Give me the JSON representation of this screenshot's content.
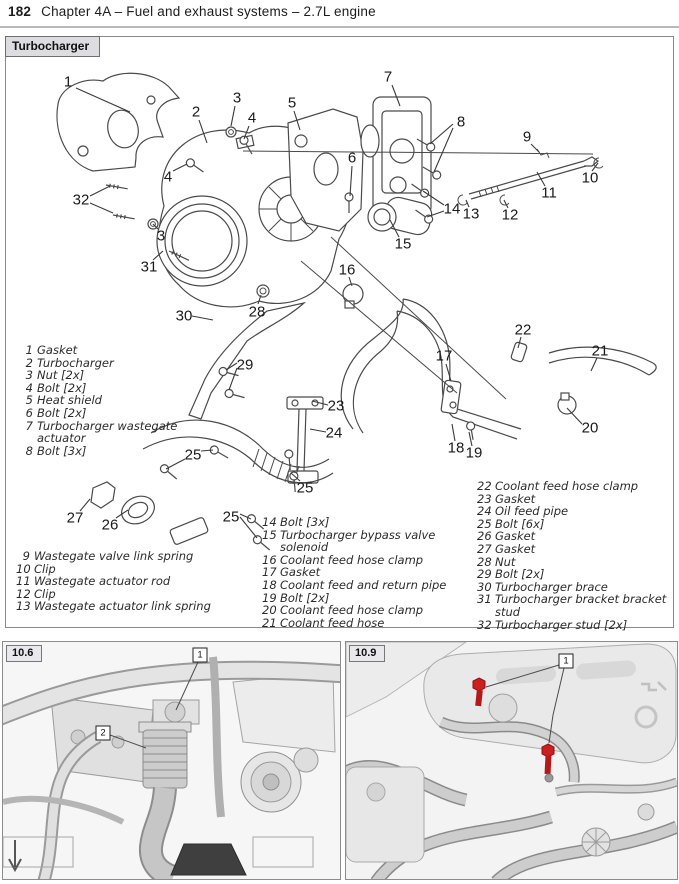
{
  "page": {
    "number": "182",
    "title": "Chapter 4A – Fuel and exhaust systems – 2.7L engine"
  },
  "figure": {
    "tab": "Turbocharger",
    "legend": {
      "columns": [
        {
          "x": 25,
          "y": 344,
          "w": 168,
          "nw": 8,
          "items": [
            {
              "num": "1",
              "text": "Gasket"
            },
            {
              "num": "2",
              "text": "Turbocharger"
            },
            {
              "num": "3",
              "text": "Nut [2x]"
            },
            {
              "num": "4",
              "text": "Bolt [2x]"
            },
            {
              "num": "5",
              "text": "Heat shield"
            },
            {
              "num": "6",
              "text": "Bolt [2x]"
            },
            {
              "num": "7",
              "text": "Turbocharger wastegate actuator"
            },
            {
              "num": "8",
              "text": "Bolt [3x]"
            }
          ]
        },
        {
          "x": 16,
          "y": 550,
          "w": 205,
          "nw": 14,
          "items": [
            {
              "num": "9",
              "text": "Wastegate valve link spring"
            },
            {
              "num": "10",
              "text": "Clip"
            },
            {
              "num": "11",
              "text": "Wastegate actuator rod"
            },
            {
              "num": "12",
              "text": "Clip"
            },
            {
              "num": "13",
              "text": "Wastegate actuator link spring"
            }
          ]
        },
        {
          "x": 262,
          "y": 516,
          "w": 210,
          "nw": 14,
          "items": [
            {
              "num": "14",
              "text": "Bolt [3x]"
            },
            {
              "num": "15",
              "text": "Turbocharger bypass valve solenoid"
            },
            {
              "num": "16",
              "text": "Coolant feed hose clamp"
            },
            {
              "num": "17",
              "text": "Gasket"
            },
            {
              "num": "18",
              "text": "Coolant feed and return pipe"
            },
            {
              "num": "19",
              "text": "Bolt [2x]"
            },
            {
              "num": "20",
              "text": "Coolant feed hose clamp"
            },
            {
              "num": "21",
              "text": "Coolant feed hose"
            }
          ]
        },
        {
          "x": 477,
          "y": 480,
          "w": 200,
          "nw": 14,
          "items": [
            {
              "num": "22",
              "text": "Coolant feed hose clamp"
            },
            {
              "num": "23",
              "text": "Gasket"
            },
            {
              "num": "24",
              "text": "Oil feed pipe"
            },
            {
              "num": "25",
              "text": "Bolt [6x]"
            },
            {
              "num": "26",
              "text": "Gasket"
            },
            {
              "num": "27",
              "text": "Gasket"
            },
            {
              "num": "28",
              "text": "Nut"
            },
            {
              "num": "29",
              "text": "Bolt [2x]"
            },
            {
              "num": "30",
              "text": "Turbocharger brace"
            },
            {
              "num": "31",
              "text": "Turbocharger bracket bracket stud"
            },
            {
              "num": "32",
              "text": "Turbocharger stud [2x]"
            }
          ]
        }
      ]
    },
    "callouts": [
      {
        "n": "1",
        "x": 68,
        "y": 82,
        "leaders": [
          [
            [
              76,
              88
            ],
            [
              130,
              112
            ]
          ]
        ]
      },
      {
        "n": "2",
        "x": 196,
        "y": 112,
        "leaders": [
          [
            [
              199,
              120
            ],
            [
              207,
              143
            ]
          ]
        ]
      },
      {
        "n": "3",
        "x": 237,
        "y": 98,
        "leaders": [
          [
            [
              235,
              106
            ],
            [
              231,
              126
            ]
          ]
        ]
      },
      {
        "n": "4",
        "x": 252,
        "y": 118,
        "leaders": [
          [
            [
              249,
              126
            ],
            [
              244,
              139
            ]
          ]
        ]
      },
      {
        "n": "5",
        "x": 292,
        "y": 103,
        "leaders": [
          [
            [
              294,
              111
            ],
            [
              300,
              130
            ]
          ]
        ]
      },
      {
        "n": "6",
        "x": 352,
        "y": 158,
        "leaders": [
          [
            [
              352,
              166
            ],
            [
              350,
              196
            ]
          ]
        ]
      },
      {
        "n": "7",
        "x": 388,
        "y": 77,
        "leaders": [
          [
            [
              392,
              85
            ],
            [
              400,
              106
            ]
          ]
        ]
      },
      {
        "n": "8",
        "x": 461,
        "y": 122,
        "leaders": [
          [
            [
              453,
              124
            ],
            [
              430,
              144
            ]
          ],
          [
            [
              453,
              128
            ],
            [
              434,
              172
            ]
          ]
        ]
      },
      {
        "n": "9",
        "x": 527,
        "y": 137,
        "leaders": [
          [
            [
              531,
              144
            ],
            [
              539,
              152
            ]
          ]
        ]
      },
      {
        "n": "10",
        "x": 590,
        "y": 178,
        "leaders": [
          [
            [
              592,
              171
            ],
            [
              598,
              163
            ]
          ]
        ]
      },
      {
        "n": "11",
        "x": 549,
        "y": 193,
        "leaders": [
          [
            [
              545,
              186
            ],
            [
              537,
              172
            ]
          ]
        ]
      },
      {
        "n": "12",
        "x": 510,
        "y": 215,
        "leaders": [
          [
            [
              508,
              208
            ],
            [
              504,
              200
            ]
          ]
        ]
      },
      {
        "n": "13",
        "x": 471,
        "y": 214,
        "leaders": [
          [
            [
              469,
              207
            ],
            [
              466,
              200
            ]
          ]
        ]
      },
      {
        "n": "14",
        "x": 452,
        "y": 209,
        "leaders": [
          [
            [
              444,
              205
            ],
            [
              423,
              191
            ]
          ],
          [
            [
              444,
              211
            ],
            [
              427,
              217
            ]
          ]
        ]
      },
      {
        "n": "15",
        "x": 403,
        "y": 244,
        "leaders": [
          [
            [
              399,
              237
            ],
            [
              390,
              220
            ]
          ]
        ]
      },
      {
        "n": "16",
        "x": 347,
        "y": 270,
        "leaders": [
          [
            [
              349,
              277
            ],
            [
              352,
              286
            ]
          ]
        ]
      },
      {
        "n": "17",
        "x": 444,
        "y": 356,
        "leaders": [
          [
            [
              446,
              364
            ],
            [
              451,
              381
            ]
          ]
        ]
      },
      {
        "n": "18",
        "x": 456,
        "y": 448,
        "leaders": [
          [
            [
              455,
              441
            ],
            [
              452,
              424
            ]
          ]
        ]
      },
      {
        "n": "19",
        "x": 474,
        "y": 453,
        "leaders": [
          [
            [
              472,
              446
            ],
            [
              469,
              432
            ]
          ]
        ]
      },
      {
        "n": "20",
        "x": 590,
        "y": 428,
        "leaders": [
          [
            [
              582,
              424
            ],
            [
              567,
              408
            ]
          ]
        ]
      },
      {
        "n": "21",
        "x": 600,
        "y": 351,
        "leaders": [
          [
            [
              597,
              358
            ],
            [
              591,
              371
            ]
          ]
        ]
      },
      {
        "n": "22",
        "x": 523,
        "y": 330,
        "leaders": [
          [
            [
              521,
              337
            ],
            [
              518,
              348
            ]
          ]
        ]
      },
      {
        "n": "23",
        "x": 336,
        "y": 406,
        "leaders": [
          [
            [
              328,
              405
            ],
            [
              312,
              401
            ]
          ]
        ]
      },
      {
        "n": "24",
        "x": 334,
        "y": 433,
        "leaders": [
          [
            [
              326,
              432
            ],
            [
              310,
              429
            ]
          ]
        ]
      },
      {
        "n": "25",
        "x": 193,
        "y": 455,
        "leaders": [
          [
            [
              185,
              459
            ],
            [
              166,
              469
            ]
          ],
          [
            [
              201,
              451
            ],
            [
              213,
              450
            ]
          ]
        ]
      },
      {
        "n": "25",
        "x": 305,
        "y": 488,
        "leaders": [
          [
            [
              300,
              481
            ],
            [
              291,
              473
            ]
          ]
        ]
      },
      {
        "n": "25",
        "x": 231,
        "y": 517,
        "leaders": [
          [
            [
              240,
              514
            ],
            [
              251,
              519
            ]
          ],
          [
            [
              240,
              517
            ],
            [
              257,
              538
            ]
          ]
        ]
      },
      {
        "n": "26",
        "x": 110,
        "y": 525,
        "leaders": [
          [
            [
              116,
              518
            ],
            [
              128,
              510
            ]
          ]
        ]
      },
      {
        "n": "27",
        "x": 75,
        "y": 518,
        "leaders": [
          [
            [
              80,
              511
            ],
            [
              90,
              499
            ]
          ]
        ]
      },
      {
        "n": "28",
        "x": 257,
        "y": 312,
        "leaders": [
          [
            [
              258,
              304
            ],
            [
              261,
              295
            ]
          ]
        ]
      },
      {
        "n": "29",
        "x": 245,
        "y": 365,
        "leaders": [
          [
            [
              237,
              363
            ],
            [
              226,
              370
            ]
          ],
          [
            [
              237,
              368
            ],
            [
              229,
              390
            ]
          ]
        ]
      },
      {
        "n": "30",
        "x": 184,
        "y": 316,
        "leaders": [
          [
            [
              192,
              316
            ],
            [
              213,
              320
            ]
          ]
        ]
      },
      {
        "n": "31",
        "x": 149,
        "y": 267,
        "leaders": [
          [
            [
              153,
              260
            ],
            [
              163,
              251
            ]
          ]
        ]
      },
      {
        "n": "32",
        "x": 81,
        "y": 200,
        "leaders": [
          [
            [
              90,
              196
            ],
            [
              110,
              186
            ]
          ],
          [
            [
              90,
              203
            ],
            [
              113,
              213
            ]
          ]
        ]
      },
      {
        "n": "3",
        "x": 161,
        "y": 236,
        "leaders": [
          [
            [
              158,
              229
            ],
            [
              153,
              224
            ]
          ]
        ]
      },
      {
        "n": "4",
        "x": 168,
        "y": 177,
        "leaders": [
          [
            [
              173,
              171
            ],
            [
              187,
              164
            ]
          ]
        ]
      }
    ]
  },
  "photos": [
    {
      "label": "10.6",
      "markers": [
        {
          "n": "1",
          "x": 200,
          "y": 655,
          "leaders": [
            [
              [
                198,
                662
              ],
              [
                176,
                710
              ]
            ]
          ]
        },
        {
          "n": "2",
          "x": 103,
          "y": 733,
          "leaders": [
            [
              [
                110,
                735
              ],
              [
                146,
                748
              ]
            ]
          ]
        }
      ]
    },
    {
      "label": "10.9",
      "markers": [
        {
          "n": "1",
          "x": 566,
          "y": 661,
          "leaders": [
            [
              [
                559,
                665
              ],
              [
                486,
                687
              ]
            ],
            [
              [
                564,
                668
              ],
              [
                553,
                715
              ],
              [
                549,
                743
              ]
            ]
          ]
        }
      ]
    }
  ],
  "colors": {
    "highlight_bolt_red": "#cc2020",
    "tab_background": "#dcdce1",
    "line_art": "#4a4a4a"
  }
}
